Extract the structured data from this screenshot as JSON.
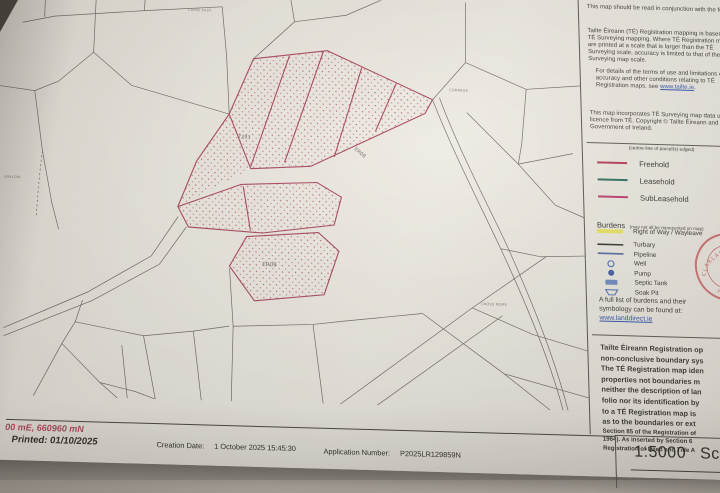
{
  "panel": {
    "para1": "This map should be read in conjunction with the folio.",
    "para2": "Tailte Éireann (TÉ) Registration mapping is based on TÉ Surveying mapping. Where TÉ Registration maps are printed at a scale that is larger than the TÉ Surveying scale, accuracy is limited to that of the TÉ Surveying map scale.",
    "para3_prefix": "For details of the terms of use and limitations of scale, accuracy and other conditions relating to TÉ Registration maps, see ",
    "para3_link": "www.tailte.ie",
    "para3_suffix": ".",
    "para4": "This map incorporates TÉ Surveying map data under licence from TÉ. Copyright © Tailte Éireann and Government of Ireland.",
    "legend": {
      "caption": "(centre-line of parcel(s) edged)",
      "items": [
        {
          "label": "Freehold",
          "color": "#b5394f"
        },
        {
          "label": "Leasehold",
          "color": "#2e6b5e"
        },
        {
          "label": "SubLeasehold",
          "color": "#b93a6e"
        }
      ]
    },
    "burdens": {
      "title": "Burdens",
      "subtitle": "(may not all be represented on map)",
      "items": [
        {
          "label": "Right of Way / Wayleave",
          "symbol": "yellow-band"
        },
        {
          "label": "Turbary",
          "symbol": "black-line"
        },
        {
          "label": "Pipeline",
          "symbol": "blue-line"
        },
        {
          "label": "Well",
          "symbol": "circle-outline"
        },
        {
          "label": "Pump",
          "symbol": "circle-filled"
        },
        {
          "label": "Septic Tank",
          "symbol": "blue-rect"
        },
        {
          "label": "Soak Pit",
          "symbol": "trapezoid"
        }
      ]
    },
    "burdens_note_line1": "A full list of burdens and their",
    "burdens_note_line2": "symbology can be found at:",
    "burdens_link": "www.landdirect.ie",
    "red_notice_big_lines": [
      "Tailte Éireann Registration op",
      "non-conclusive boundary sys",
      "The TÉ Registration map iden",
      "properties not boundaries m",
      "neither the description of lan",
      "folio nor its identification by",
      "to a TÉ Registration map is",
      "as to the boundaries or ext"
    ],
    "red_notice_small_lines": [
      "Section 85 of the Registration of",
      "1964). As inserted by Section 6",
      "Registration of Deed and Title A"
    ],
    "stamp": {
      "top_text": "CLÁRLANN NA TALÚN",
      "bottom_text": "PRÍOMH OIFIG",
      "color": "#c25050"
    }
  },
  "map": {
    "parcel_labels": [
      {
        "text": "7293"
      },
      {
        "text": "ER08"
      },
      {
        "text": "ER08"
      }
    ],
    "place_labels": [
      {
        "text": "LAHID EAST"
      },
      {
        "text": "ARKLOW"
      },
      {
        "text": "CORRAGE"
      },
      {
        "text": "CROSS MORE"
      }
    ],
    "colors": {
      "parcel_edge": "#a64257",
      "field_line": "#57534c",
      "stipple": "#b4606e"
    }
  },
  "footer": {
    "coords": "00 mE, 660960 mN",
    "printed": "Printed: 01/10/2025",
    "creation_label": "Creation Date:",
    "creation_value": "1 October 2025 15:45:30",
    "application_label": "Application Number:",
    "application_value": "P2025LR129859N",
    "scale_ratio": "1:5000",
    "scale_word": "Scale"
  }
}
